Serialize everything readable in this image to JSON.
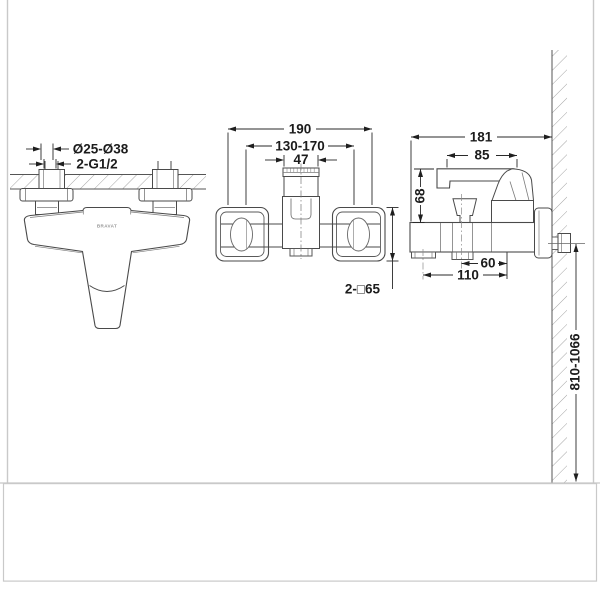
{
  "drawing": {
    "brand": "BRAVAT",
    "front_view": {
      "connector_diameter": "Ø25-Ø38",
      "thread": "2-G1/2"
    },
    "top_view": {
      "overall_width": "190",
      "center_range": "130-170",
      "cartridge_width": "47",
      "escutcheon_size": "2-□65"
    },
    "side_view": {
      "overall_depth": "181",
      "handle_length": "85",
      "handle_height": "68",
      "outlet_offset": "60",
      "spout_offset": "110",
      "installation_height": "810-1066"
    }
  }
}
